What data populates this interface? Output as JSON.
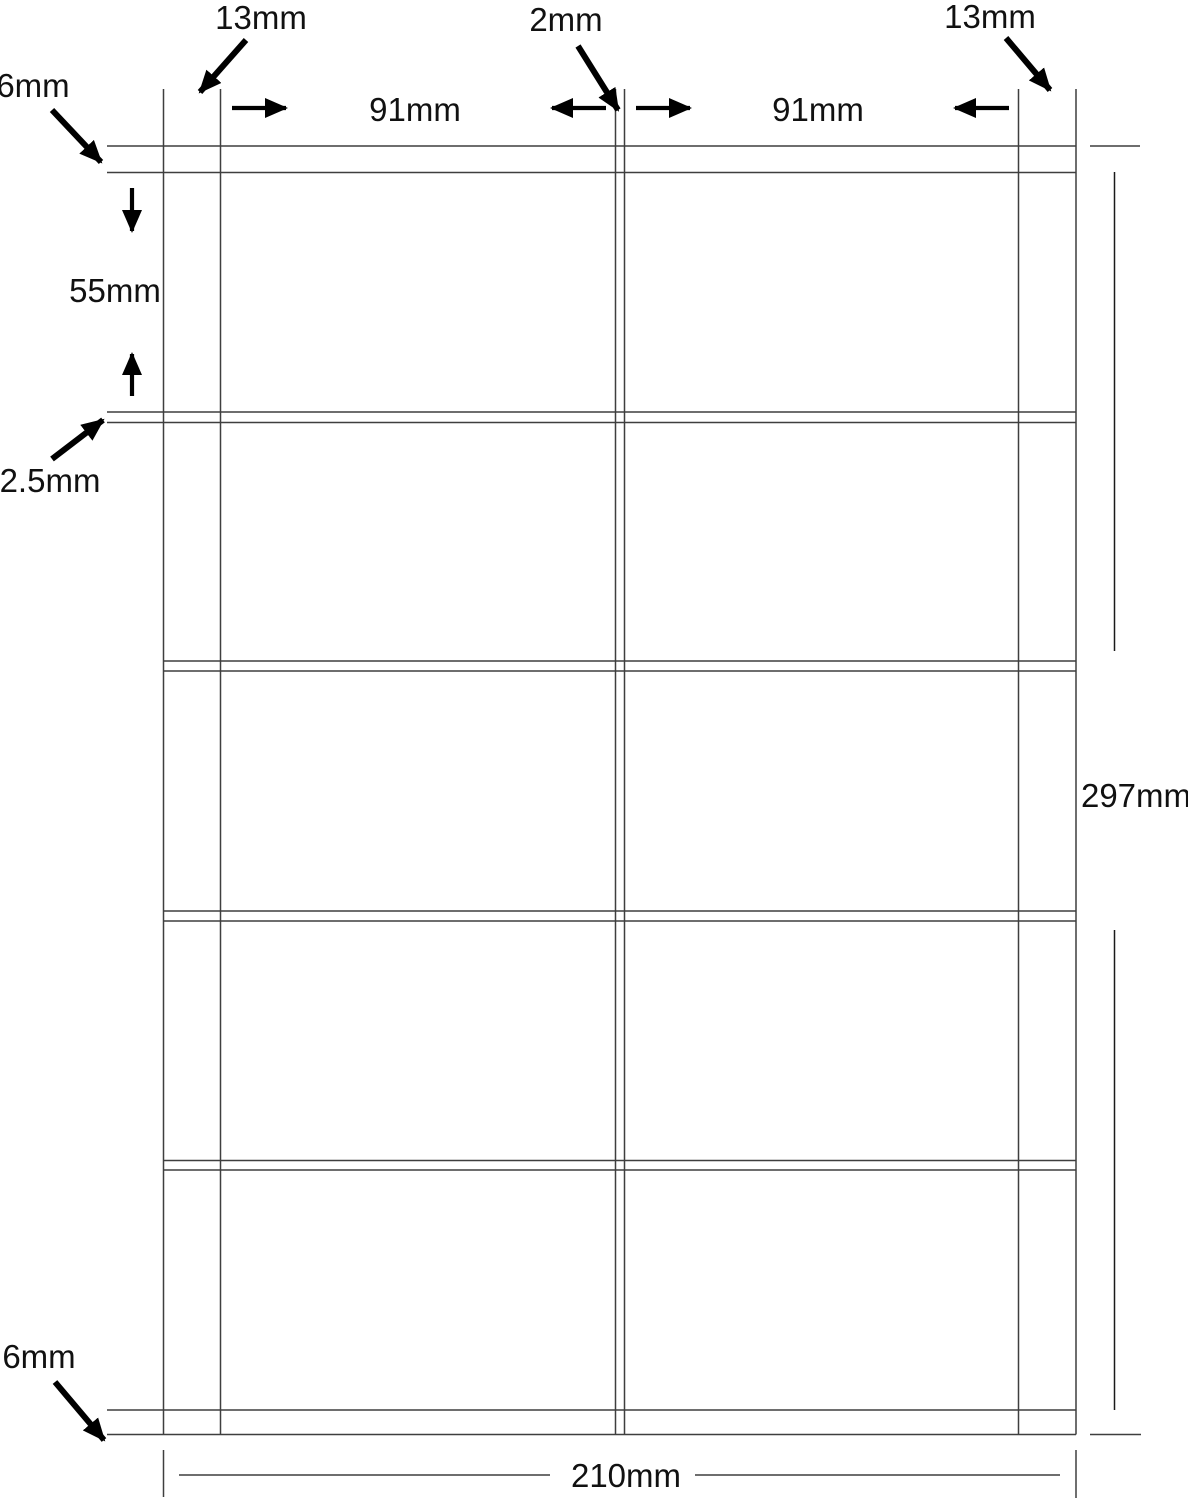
{
  "diagram": {
    "kind": "label-sheet-dimension-diagram",
    "page": {
      "width": "210mm",
      "height": "297mm"
    },
    "grid": {
      "columns": 2,
      "rows": 5,
      "label_width": "91mm",
      "label_height": "55mm",
      "column_gap": "2mm",
      "row_gap": "2.5mm",
      "side_margin": "13mm",
      "top_bottom_margin": "6mm"
    },
    "annotations": {
      "left_margin": "13mm",
      "center_gap": "2mm",
      "right_margin": "13mm",
      "top_margin": "6mm",
      "col1_width": "91mm",
      "col2_width": "91mm",
      "label_height": "55mm",
      "row_gap": "2.5mm",
      "bottom_margin": "6mm",
      "page_height": "297mm",
      "page_width": "210mm"
    },
    "colors": {
      "background": "#ffffff",
      "line": "#3f3f3f",
      "arrow": "#000000",
      "text": "#111111"
    }
  }
}
